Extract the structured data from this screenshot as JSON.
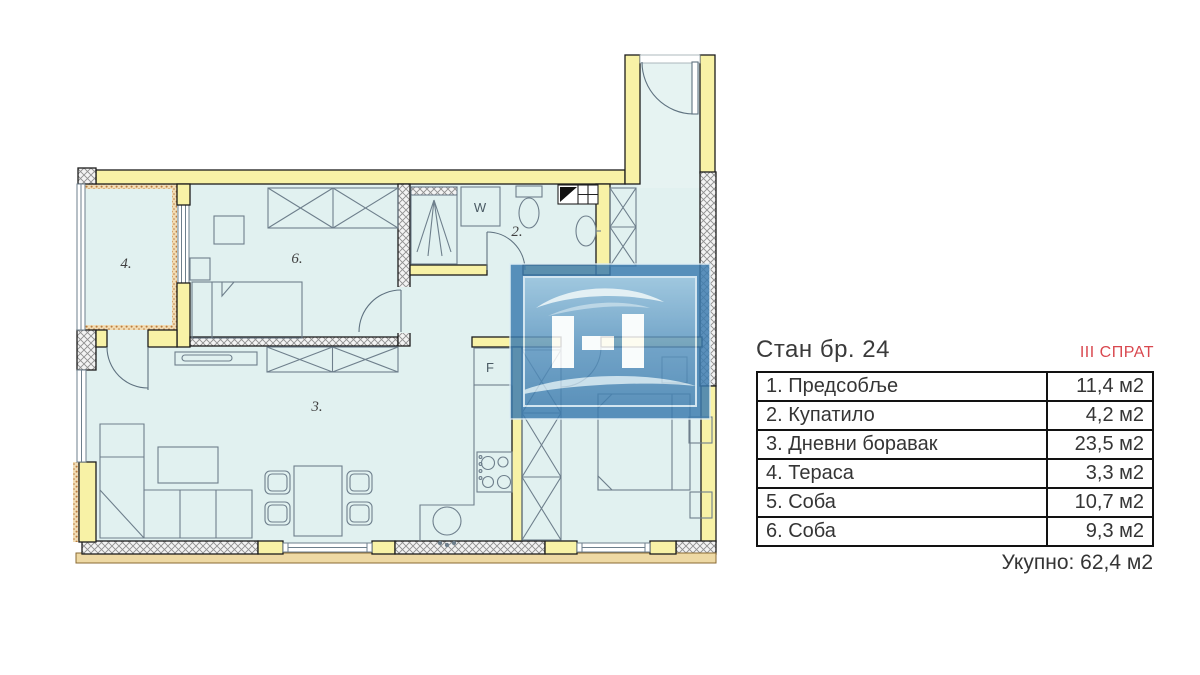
{
  "plan": {
    "room_labels": {
      "terrace": "4.",
      "bedroom6": "6.",
      "bathroom": "2.",
      "living": "3."
    },
    "appliance_labels": {
      "washer": "W",
      "fridge": "F"
    },
    "colors": {
      "floor": "#e1f1f0",
      "wall_yellow": "#f8f2a6",
      "accent_red": "#d9484f",
      "watermark_blue": "#3c7cb0",
      "outer_band_tan": "#eed9a4"
    }
  },
  "info_panel": {
    "title": "Стан бр. 24",
    "floor_label": "III СПРАТ",
    "table": {
      "rows": [
        {
          "label": "1. Предсобље",
          "area": "11,4 м2"
        },
        {
          "label": "2. Купатило",
          "area": "4,2 м2"
        },
        {
          "label": "3. Дневни боравак",
          "area": "23,5 м2"
        },
        {
          "label": "4. Тераса",
          "area": "3,3 м2"
        },
        {
          "label": "5. Соба",
          "area": "10,7 м2"
        },
        {
          "label": "6. Соба",
          "area": "9,3 м2"
        }
      ]
    },
    "total": "Укупно: 62,4 м2"
  }
}
